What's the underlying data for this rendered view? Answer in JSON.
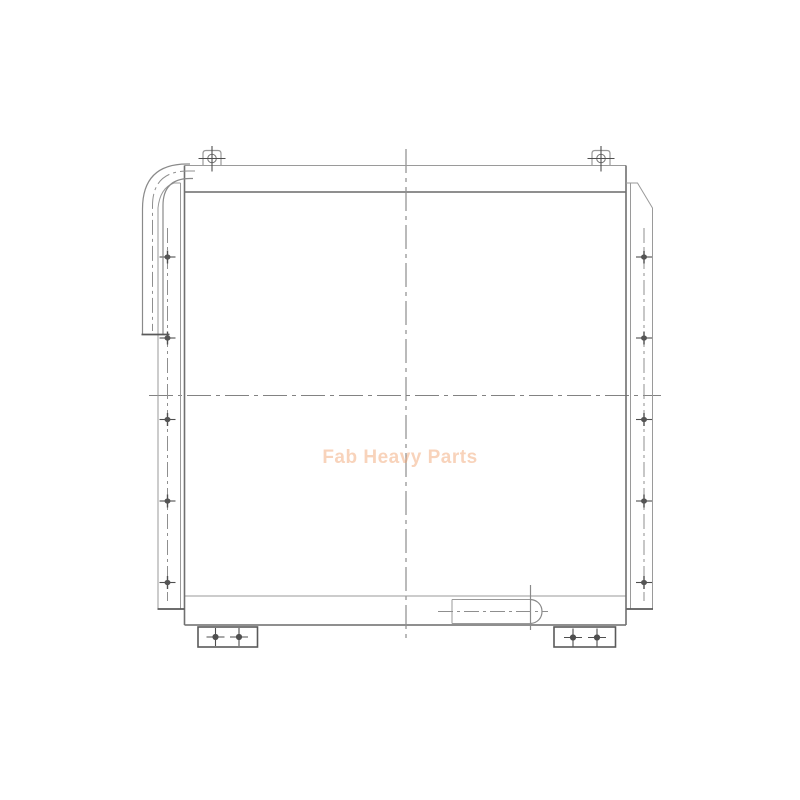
{
  "page": {
    "background_color": "#ffffff",
    "content_type": "technical line drawing of an oil cooler / radiator assembly"
  },
  "watermark": {
    "text": "Fab Heavy Parts",
    "color": "rgba(240,158,105,0.45)"
  },
  "drawing": {
    "line_color": "#8a8a8a",
    "detail_color": "#4f4f4f",
    "centerline_color": "#828282"
  }
}
